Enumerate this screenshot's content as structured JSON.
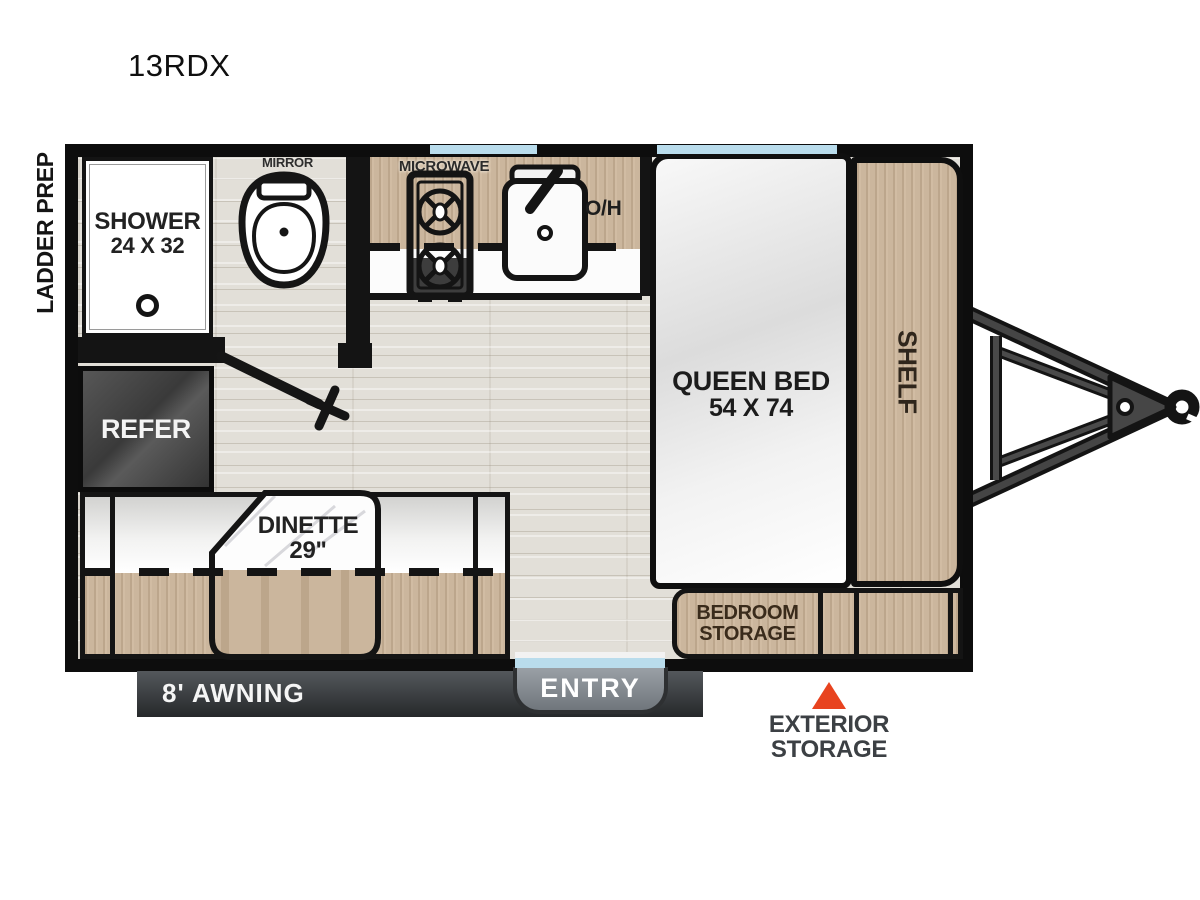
{
  "title": "13RDX",
  "side_label": "LADDER PREP",
  "bathroom": {
    "mirror": "MIRROR",
    "shower_name": "SHOWER",
    "shower_size": "24 X 32"
  },
  "kitchen": {
    "microwave": "MICROWAVE",
    "overhead_abbr": "O/H"
  },
  "bedroom": {
    "bed_name": "QUEEN BED",
    "bed_size": "54 X 74",
    "shelf": "SHELF",
    "storage_line1": "BEDROOM",
    "storage_line2": "STORAGE"
  },
  "living": {
    "refer": "REFER",
    "dinette_name": "DINETTE",
    "dinette_size": "29\"",
    "overhead": "OVERHEAD"
  },
  "exterior": {
    "awning": "8' AWNING",
    "entry": "ENTRY",
    "storage_line1": "EXTERIOR",
    "storage_line2": "STORAGE"
  },
  "icons": {
    "toilet": "toilet-top-view",
    "stove": "two-burner-stove",
    "sink": "kitchen-sink",
    "drain": "shower-drain",
    "door": "door-swing",
    "hitch": "trailer-tongue-hitch",
    "marker": "exterior-storage-triangle"
  },
  "colors": {
    "wall": "#0d0d0d",
    "wood": "#cbb69d",
    "window_blue": "#b9dcec",
    "floor": "#e2dfd8",
    "marker_red": "#e8431f",
    "awning_gray": "#3a3d41",
    "entry_gray": "#8b9298",
    "refer_gray": "#434343"
  }
}
